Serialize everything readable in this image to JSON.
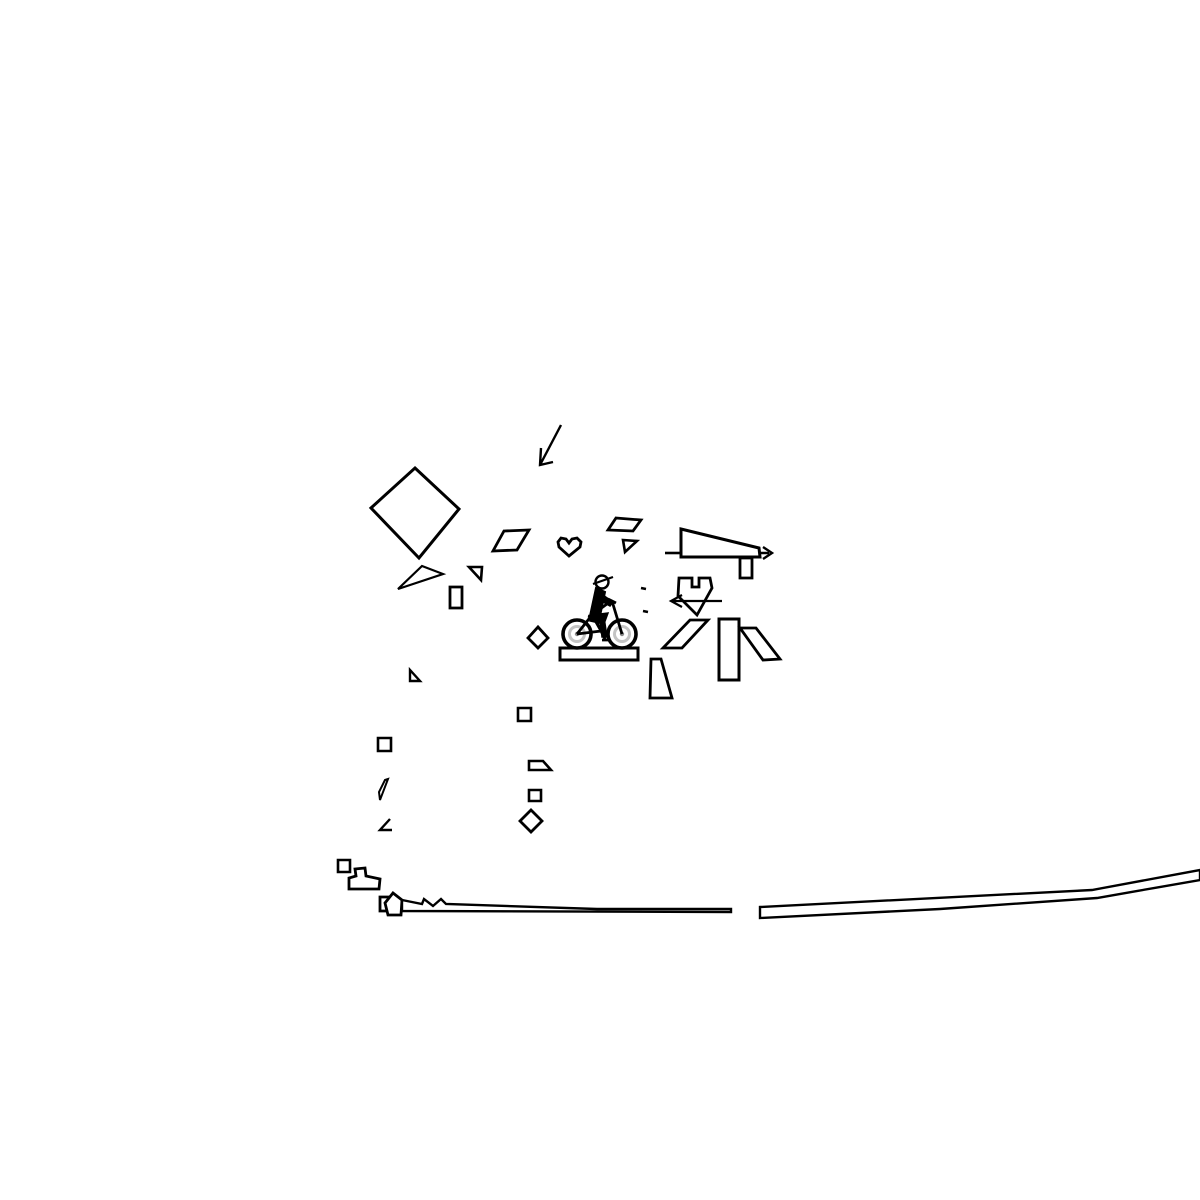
{
  "app": {
    "name": "bike-track-drawing-game",
    "background_color": "#ffffff",
    "ink_color": "#000000",
    "wheel_rim_color": "#c3c3c3",
    "wheel_hub_color": "#8a8a8a"
  },
  "canvas": {
    "width": 1200,
    "height": 1200,
    "default_stroke_width": 2.6
  },
  "scene": {
    "shapes": [
      {
        "name": "cursor-arrow-icon",
        "d": "M561 425 L540 465 M541 448 L540 465 L553 462",
        "sw": 2.4
      },
      {
        "name": "big-diamond",
        "d": "M415 468 L459 509 L419 558 L371 508 Z",
        "sw": 3
      },
      {
        "name": "triangle-wedge-left",
        "d": "M422 566 L443 574 L398 589 Z",
        "sw": 2.2
      },
      {
        "name": "parallelogram-mid",
        "d": "M504 531 L529 530 L517 550 L493 551 Z",
        "sw": 2.8
      },
      {
        "name": "heart-shape",
        "d": "M558 542 L561 538 L566 539 L569 543 L572 539 L577 538 L581 542 L580 547 L569 556 L559 547 Z",
        "sw": 2.8
      },
      {
        "name": "parallelogram-top",
        "d": "M616 518 L641 520 L633 531 L608 530 Z",
        "sw": 2.8
      },
      {
        "name": "flag-triangle-upper",
        "d": "M623 540 L637 541 L625 552 Z",
        "sw": 2.6
      },
      {
        "name": "gun-left-line",
        "d": "M665 553 L681 553",
        "sw": 2.6
      },
      {
        "name": "gun-wedge-body",
        "d": "M681 529 L759 548 L760 557 L681 557 Z",
        "sw": 3
      },
      {
        "name": "gun-arrow-right",
        "d": "M759 553 L769 553 M763 547 L772 553 L763 559",
        "sw": 2.4
      },
      {
        "name": "gun-hanging-rect",
        "d": "M740 558 L752 558 L752 578 L740 578 Z",
        "sw": 2.8
      },
      {
        "name": "crown-shield",
        "d": "M679 578 L692 578 L692 587 L699 587 L699 578 L710 578 L712 588 L697 615 L678 596 Z",
        "sw": 2.8
      },
      {
        "name": "crown-arrow-left",
        "d": "M722 601 L671 601 M682 595 L671 601 L682 607",
        "sw": 2.2
      },
      {
        "name": "dash-mark-1",
        "d": "M641 588 L646 589",
        "sw": 2.6
      },
      {
        "name": "dash-mark-2",
        "d": "M643 611 L648 612",
        "sw": 2.6
      },
      {
        "name": "flag-triangle-small",
        "d": "M469 567 L482 567 L481 580 Z",
        "sw": 2.6
      },
      {
        "name": "small-vertical-rect",
        "d": "M450 587 L462 587 L462 608 L450 608 Z",
        "sw": 2.8
      },
      {
        "name": "small-diamond-left",
        "d": "M538 627 L548 638 L538 648 L528 638 Z",
        "sw": 2.8
      },
      {
        "name": "bike-platform",
        "d": "M560 648 L638 648 L638 660 L560 660 Z",
        "sw": 3
      },
      {
        "name": "parallelogram-right",
        "d": "M690 620 L708 620 L682 648 L663 648 Z",
        "sw": 2.8
      },
      {
        "name": "tall-rect",
        "d": "M719 619 L739 619 L739 680 L719 680 Z",
        "sw": 3
      },
      {
        "name": "slanted-parallelogram",
        "d": "M740 628 L756 628 L780 659 L763 660 Z",
        "sw": 2.8
      },
      {
        "name": "trapezoid-lower",
        "d": "M651 659 L661 659 L672 698 L650 698 Z",
        "sw": 2.8
      },
      {
        "name": "tiny-triangle",
        "d": "M410 670 L410 681 L420 681 Z",
        "sw": 2.4
      },
      {
        "name": "tiny-square-1",
        "d": "M518 708 L531 708 L531 721 L518 721 Z",
        "sw": 2.6
      },
      {
        "name": "tiny-square-2",
        "d": "M378 738 L391 738 L391 751 L378 751 Z",
        "sw": 2.6
      },
      {
        "name": "tiny-trapezoid",
        "d": "M529 761 L543 761 L551 770 L529 770 Z",
        "sw": 2.6
      },
      {
        "name": "thin-sliver",
        "d": "M380 800 L388 779 L385 780 L379 792 Z",
        "sw": 2
      },
      {
        "name": "tiny-square-3",
        "d": "M529 790 L541 790 L541 801 L529 801 Z",
        "sw": 2.6
      },
      {
        "name": "angle-mark",
        "d": "M390 819 L380 830 L392 830",
        "sw": 2.4
      },
      {
        "name": "small-diamond-lower",
        "d": "M531 810 L542 821 L531 832 L520 821 Z",
        "sw": 2.8
      },
      {
        "name": "tiny-square-4",
        "d": "M338 860 L350 860 L350 872 L338 872 Z",
        "sw": 2.6
      },
      {
        "name": "boot-shape",
        "d": "M355 869 L365 868 L366 876 L380 879 L379 889 L349 889 L349 878 L356 876 Z",
        "sw": 2.8
      },
      {
        "name": "plug-square",
        "d": "M380 897 L393 897 L393 911 L380 911 Z",
        "sw": 2.8
      },
      {
        "name": "plug-pentagon",
        "d": "M393 893 L402 900 L401 915 L388 915 L385 903 Z",
        "fill": "#ffffff",
        "sw": 2.8
      },
      {
        "name": "terrain-left",
        "d": "M402 900 L422 904 L424 899 L433 906 L441 899 L446 904 L597 909 L731 909 L731 912 L402 911 Z",
        "fill": "#ffffff",
        "sw": 2.4
      },
      {
        "name": "terrain-right",
        "d": "M760 907 L1092 890 L1200 870 L1200 880 L1097 898 L940 909 L760 918 Z",
        "fill": "#ffffff",
        "sw": 2.4
      },
      {
        "name": "bike-rear-wheel-tire",
        "d": "M563 634 a14 14 0 1 0 28 0 a14 14 0 1 0 -28 0",
        "sw": 3.6
      },
      {
        "name": "bike-rear-wheel-rim",
        "d": "M569.5 634 a7.5 7.5 0 1 0 15 0 a7.5 7.5 0 1 0 -15 0",
        "stroke": "#c3c3c3",
        "sw": 3
      },
      {
        "name": "bike-rear-wheel-hub",
        "d": "M574.8 634 a2.2 2.2 0 1 0 4.4 0 a2.2 2.2 0 1 0 -4.4 0",
        "fill": "#8a8a8a",
        "stroke": "none"
      },
      {
        "name": "bike-front-wheel-tire",
        "d": "M608 634 a14 14 0 1 0 28 0 a14 14 0 1 0 -28 0",
        "sw": 3.6
      },
      {
        "name": "bike-front-wheel-rim",
        "d": "M614.5 634 a7.5 7.5 0 1 0 15 0 a7.5 7.5 0 1 0 -15 0",
        "stroke": "#c3c3c3",
        "sw": 3
      },
      {
        "name": "bike-front-wheel-hub",
        "d": "M619.8 634 a2.2 2.2 0 1 0 4.4 0 a2.2 2.2 0 1 0 -4.4 0",
        "fill": "#8a8a8a",
        "stroke": "none"
      },
      {
        "name": "bike-frame",
        "d": "M577 634 L601 631 L592 615 L577 634 M601 631 L597 622 M592 615 L611 601 M608 599 L616 603 M612 601 L622 634 M601 631 L605 639 M602 640 L609 640 M588 616 L596 618",
        "sw": 2.8
      },
      {
        "name": "rider-torso",
        "d": "M596 588 L605 592 L599 621 L590 616 Z",
        "fill": "#000000",
        "sw": 2
      },
      {
        "name": "rider-arm",
        "d": "M600 593 L613 602 L610 606 L598 599 Z",
        "fill": "#000000",
        "sw": 1.5
      },
      {
        "name": "rider-thigh",
        "d": "M592 615 L608 613 L604 624 L590 621 Z",
        "fill": "#000000",
        "sw": 1.5
      },
      {
        "name": "rider-shin",
        "d": "M604 617 L607 637 L602 637 L600 619 Z",
        "fill": "#000000",
        "sw": 1.5
      },
      {
        "name": "rider-head",
        "d": "M595.5 582 a6.5 6.5 0 1 0 13 0 a6.5 6.5 0 1 0 -13 0",
        "fill": "#ffffff",
        "sw": 2.4
      },
      {
        "name": "rider-cap-brim",
        "d": "M593 584 L613 577",
        "sw": 2.2
      }
    ]
  }
}
